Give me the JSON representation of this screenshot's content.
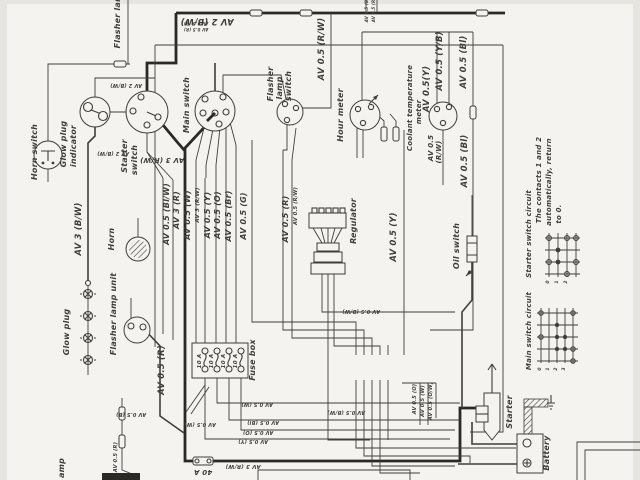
{
  "diagram": {
    "ink": "#3f3e3a",
    "paper": "#f4f3ef",
    "labels": [
      {
        "t": "Horn switch",
        "x": 37,
        "y": 152,
        "n": "horn-switch-label"
      },
      {
        "t": "Glow plug",
        "x": 66,
        "y": 144,
        "n": "glow-plug-indicator-label-1"
      },
      {
        "t": "indicator",
        "x": 76,
        "y": 146,
        "n": "glow-plug-indicator-label-2"
      },
      {
        "t": "Starter",
        "x": 127,
        "y": 156,
        "n": "starter-switch-label-1"
      },
      {
        "t": "switch",
        "x": 137,
        "y": 160,
        "n": "starter-switch-label-2"
      },
      {
        "t": "Main switch",
        "x": 189,
        "y": 105,
        "n": "main-switch-label"
      },
      {
        "t": "Flasher",
        "x": 273,
        "y": 84,
        "n": "flasher-lamp-switch-label-1"
      },
      {
        "t": "lamp",
        "x": 282,
        "y": 88,
        "n": "flasher-lamp-switch-label-2"
      },
      {
        "t": "switch",
        "x": 291,
        "y": 86,
        "n": "flasher-lamp-switch-label-3"
      },
      {
        "t": "Hour meter",
        "x": 343,
        "y": 115,
        "n": "hour-meter-label"
      },
      {
        "t": "Coolant temperature",
        "x": 412,
        "y": 108,
        "s": 7,
        "n": "coolant-meter-label-1"
      },
      {
        "t": "meter",
        "x": 421,
        "y": 112,
        "s": 7,
        "n": "coolant-meter-label-2"
      },
      {
        "t": "Regulator",
        "x": 356,
        "y": 221,
        "n": "regulator-label"
      },
      {
        "t": "Oil switch",
        "x": 459,
        "y": 246,
        "n": "oil-switch-label"
      },
      {
        "t": "Fuse box",
        "x": 255,
        "y": 360,
        "n": "fuse-box-label"
      },
      {
        "t": "Flasher lamp unit",
        "x": 116,
        "y": 314,
        "n": "flasher-lamp-unit-label"
      },
      {
        "t": "Horn",
        "x": 114,
        "y": 239,
        "n": "horn-label"
      },
      {
        "t": "Glow plug",
        "x": 69,
        "y": 332,
        "n": "glow-plug-label"
      },
      {
        "t": "Starter",
        "x": 512,
        "y": 412,
        "n": "starter-label"
      },
      {
        "t": "Battery",
        "x": 549,
        "y": 453,
        "n": "battery-label"
      },
      {
        "t": "Starter switch circuit",
        "x": 531,
        "y": 234,
        "s": 7,
        "n": "starter-switch-circuit-label"
      },
      {
        "t": "Main switch circuit",
        "x": 531,
        "y": 331,
        "s": 7,
        "n": "main-switch-circuit-label"
      },
      {
        "t": "The contacts 1 and 2",
        "x": 541,
        "y": 180,
        "s": 7,
        "n": "note-line-1"
      },
      {
        "t": "automatically, return",
        "x": 551,
        "y": 182,
        "s": 7,
        "n": "note-line-2"
      },
      {
        "t": "to 0.",
        "x": 561,
        "y": 214,
        "s": 7,
        "n": "note-line-3"
      },
      {
        "t": "Flasher lamp",
        "x": 120,
        "y": 18,
        "n": "flasher-lamp-partial-label"
      },
      {
        "t": "amp",
        "x": 64,
        "y": 468,
        "n": "lamp-partial-label"
      },
      {
        "t": "AV 2 (B/W)",
        "x": 207,
        "y": 19,
        "r": 180,
        "s": 8.5
      },
      {
        "t": "AV 2 (B/W)",
        "x": 126,
        "y": 84,
        "r": 180,
        "s": 5
      },
      {
        "t": "AV 2 (B/W)",
        "x": 113,
        "y": 152,
        "r": 180,
        "s": 5
      },
      {
        "t": "AV 0.5 (R/W)",
        "x": 324,
        "y": 49,
        "s": 8.5
      },
      {
        "t": "AV 3 (B/W)",
        "x": 81,
        "y": 229,
        "s": 8.5
      },
      {
        "t": "AV 3 (R/W)",
        "x": 162,
        "y": 158,
        "r": 180,
        "s": 7
      },
      {
        "t": "AV 0.5 (Bl/W)",
        "x": 169,
        "y": 214
      },
      {
        "t": "AV 3 (R)",
        "x": 179,
        "y": 210
      },
      {
        "t": "AV 0.5 (W)",
        "x": 190,
        "y": 215
      },
      {
        "t": "AV 3 (R/W)",
        "x": 199,
        "y": 205,
        "s": 5.5
      },
      {
        "t": "AV 0.5 (Y)",
        "x": 210,
        "y": 215
      },
      {
        "t": "AV 0.5 (O)",
        "x": 220,
        "y": 215
      },
      {
        "t": "AV 0.5 (Br)",
        "x": 231,
        "y": 216
      },
      {
        "t": "AV 0.5 (G)",
        "x": 246,
        "y": 216
      },
      {
        "t": "AV 0.5 (R)",
        "x": 288,
        "y": 219
      },
      {
        "t": "AV 0.5 (R/W)",
        "x": 297,
        "y": 206,
        "s": 5
      },
      {
        "t": "AV 0.5 (Y)",
        "x": 396,
        "y": 237,
        "s": 8.5
      },
      {
        "t": "AV 0.5(Y)",
        "x": 429,
        "y": 89,
        "s": 8.5
      },
      {
        "t": "AV 0.5 (Y/B)",
        "x": 442,
        "y": 61,
        "s": 8.5
      },
      {
        "t": "AV 0.5 (Bl)",
        "x": 466,
        "y": 62,
        "s": 8.5
      },
      {
        "t": "AV 0.5",
        "x": 433,
        "y": 148,
        "s": 7
      },
      {
        "t": "(R/W)",
        "x": 441,
        "y": 152,
        "s": 7
      },
      {
        "t": "AV 0.5 (Bl)",
        "x": 467,
        "y": 161,
        "s": 8.5
      },
      {
        "t": "AV 0.5 (R)",
        "x": 164,
        "y": 370,
        "s": 8.5
      },
      {
        "t": "10 A",
        "x": 201,
        "y": 361,
        "s": 5.5
      },
      {
        "t": "10 A",
        "x": 213,
        "y": 361,
        "s": 5.5
      },
      {
        "t": "10 A",
        "x": 225,
        "y": 361,
        "s": 5.5
      },
      {
        "t": "10 A",
        "x": 237,
        "y": 361,
        "s": 5.5
      },
      {
        "t": "40 A",
        "x": 203,
        "y": 470,
        "r": 180,
        "s": 7
      },
      {
        "t": "AV 3 (R/W)",
        "x": 243,
        "y": 465,
        "r": 180,
        "s": 5.5
      },
      {
        "t": "AV 0.5 (W)",
        "x": 200,
        "y": 423,
        "r": 180,
        "s": 5
      },
      {
        "t": "AV 0.5 (W)",
        "x": 257,
        "y": 403,
        "r": 180,
        "s": 5
      },
      {
        "t": "AV 0.5 (Bl)",
        "x": 263,
        "y": 421,
        "r": 180,
        "s": 5
      },
      {
        "t": "AV 0.5 (O)",
        "x": 258,
        "y": 431,
        "r": 180,
        "s": 5
      },
      {
        "t": "AV 0.5 (Y)",
        "x": 253,
        "y": 440,
        "r": 180,
        "s": 5
      },
      {
        "t": "AV 0.5 (B/W)",
        "x": 361,
        "y": 310,
        "r": 180,
        "s": 5
      },
      {
        "t": "AV 0.5 (B/W)",
        "x": 346,
        "y": 411,
        "r": 180,
        "s": 5
      },
      {
        "t": "AV 0.5 (O)",
        "x": 416,
        "y": 399,
        "s": 5
      },
      {
        "t": "AV 0.5 (W)",
        "x": 424,
        "y": 401,
        "s": 5
      },
      {
        "t": "AV 0.5 (O/W)",
        "x": 432,
        "y": 401,
        "s": 5
      },
      {
        "t": "AV 0.5 (R)",
        "x": 117,
        "y": 457,
        "s": 5
      },
      {
        "t": "AV 0.5 (B)",
        "x": 131,
        "y": 413,
        "r": 180,
        "s": 5
      },
      {
        "t": "AV 0.5 (B)",
        "x": 368,
        "y": 10,
        "s": 4
      },
      {
        "t": "AV 0.5 (R)",
        "x": 375,
        "y": 10,
        "s": 4
      },
      {
        "t": "AV 0.5 (B)",
        "x": 196,
        "y": 22,
        "r": 180,
        "s": 4
      },
      {
        "t": "AV 0.5 (R)",
        "x": 196,
        "y": 28,
        "r": 180,
        "s": 4
      },
      {
        "t": "0",
        "x": 549,
        "y": 282,
        "s": 4.5
      },
      {
        "t": "1",
        "x": 558,
        "y": 282,
        "s": 4.5
      },
      {
        "t": "2",
        "x": 567,
        "y": 282,
        "s": 4.5
      },
      {
        "t": "0",
        "x": 541,
        "y": 369,
        "s": 4.5
      },
      {
        "t": "1",
        "x": 549,
        "y": 369,
        "s": 4.5
      },
      {
        "t": "2",
        "x": 557,
        "y": 369,
        "s": 4.5
      },
      {
        "t": "3",
        "x": 565,
        "y": 369,
        "s": 4.5
      }
    ]
  }
}
